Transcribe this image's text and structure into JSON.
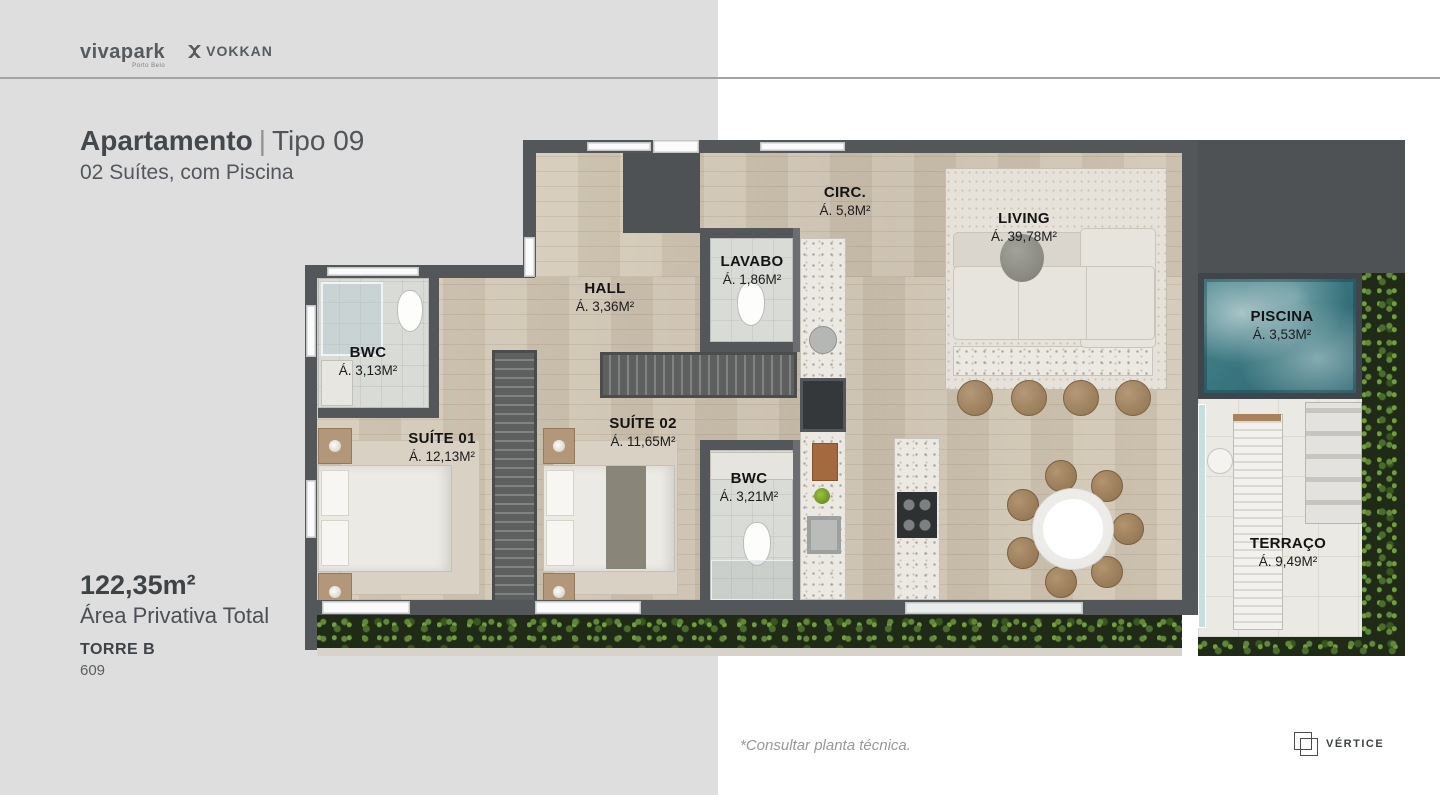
{
  "header": {
    "brand_primary": "vivapark",
    "brand_primary_sub": "Porto Belo",
    "brand_secondary": "VOKKAN"
  },
  "panel": {
    "title_bold": "Apartamento",
    "title_sep": "|",
    "title_light": "Tipo 09",
    "subtitle": "02 Suítes, com Piscina",
    "area_value": "122,35m²",
    "area_label": "Área Privativa Total",
    "tower_label": "TORRE B",
    "unit_number": "609"
  },
  "floorplan": {
    "rooms": [
      {
        "id": "circ",
        "name": "CIRC.",
        "area": "Á. 5,8M²"
      },
      {
        "id": "living",
        "name": "LIVING",
        "area": "Á. 39,78M²"
      },
      {
        "id": "hall",
        "name": "HALL",
        "area": "Á. 3,36M²"
      },
      {
        "id": "lavabo",
        "name": "LAVABO",
        "area": "Á. 1,86M²"
      },
      {
        "id": "bwc-suite01",
        "name": "BWC",
        "area": "Á. 3,13M²"
      },
      {
        "id": "suite01",
        "name": "SUÍTE 01",
        "area": "Á. 12,13M²"
      },
      {
        "id": "suite02",
        "name": "SUÍTE 02",
        "area": "Á. 11,65M²"
      },
      {
        "id": "bwc-suite02",
        "name": "BWC",
        "area": "Á. 3,21M²"
      },
      {
        "id": "piscina",
        "name": "PISCINA",
        "area": "Á. 3,53M²"
      },
      {
        "id": "terraco",
        "name": "TERRAÇO",
        "area": "Á. 9,49M²"
      }
    ]
  },
  "footer": {
    "note": "*Consultar planta técnica.",
    "brand": "VÉRTICE"
  },
  "colors": {
    "panel_bg": "#dedede",
    "page_bg": "#ffffff",
    "text_dark": "#43484d",
    "text_light": "#53585e",
    "wall": "#54575a",
    "wood_floor": "#cfc5b3",
    "tile_floor": "#d9dbd7",
    "pool_water": "#3f7f88",
    "greenery": "#24321b",
    "label_text": "#141414"
  }
}
